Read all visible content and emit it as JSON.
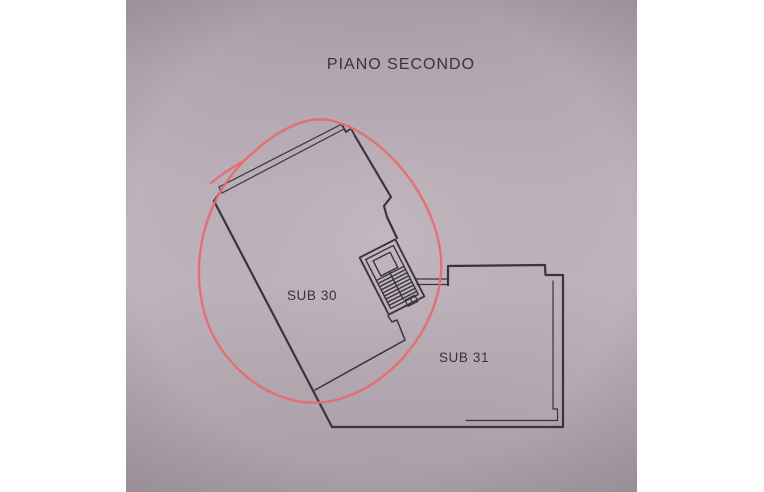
{
  "plan": {
    "title": "PIANO SECONDO",
    "units": [
      {
        "label": "SUB 30",
        "circled": true
      },
      {
        "label": "SUB 31",
        "circled": false
      }
    ],
    "annotation": {
      "shape": "hand-drawn-ellipse",
      "around": "SUB 30"
    },
    "annotation_color": "#e76a6d",
    "line_color": "#3a3340",
    "paper_color": "#b9adb6",
    "page_background": "#ffffff"
  }
}
